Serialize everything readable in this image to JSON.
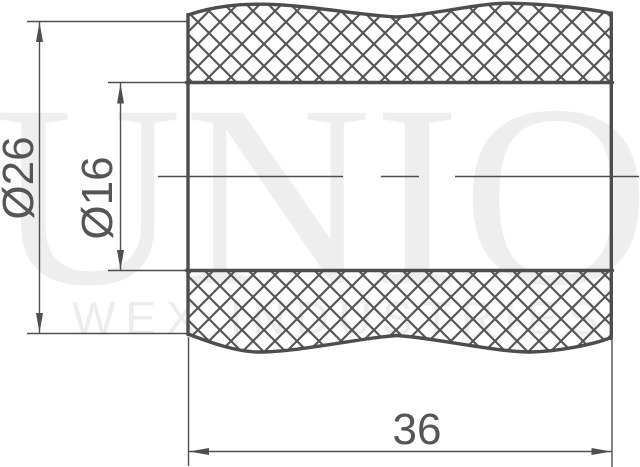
{
  "watermark": {
    "large": "UNION",
    "small": "WEX INDUSTRIES"
  },
  "dimensions": {
    "outer_diameter": {
      "label": "Ø26"
    },
    "inner_diameter": {
      "label": "Ø16"
    },
    "length": {
      "label": "36"
    }
  },
  "colors": {
    "line": "#4d4d4d",
    "hatch": "#565656",
    "dimension_text": "#555555",
    "watermark_large": "#eeeeee",
    "watermark_small": "#ececec",
    "background": "#ffffff"
  }
}
